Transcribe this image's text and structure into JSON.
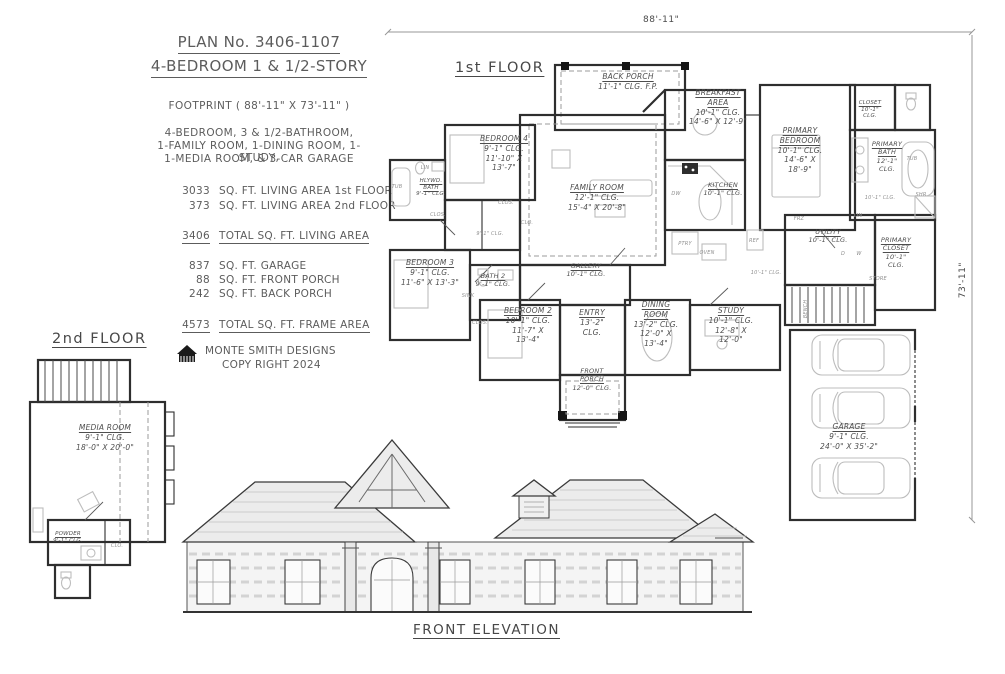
{
  "title_block": {
    "plan_no": "PLAN No. 3406-1107",
    "plan_type": "4-BEDROOM  1 & 1/2-STORY",
    "footprint": "FOOTPRINT ( 88'-11\" X 73'-11\" )",
    "description_lines": [
      "4-BEDROOM, 3 & 1/2-BATHROOM,",
      "1-FAMILY ROOM, 1-DINING ROOM, 1-STUDY,",
      "1-MEDIA ROOM, & 3-CAR GARAGE"
    ],
    "living_areas": [
      {
        "value": "3033",
        "label": "SQ. FT. LIVING AREA 1st FLOOR"
      },
      {
        "value": "373",
        "label": "SQ. FT. LIVING AREA 2nd FLOOR"
      }
    ],
    "total_living": {
      "value": "3406",
      "label": "TOTAL SQ. FT. LIVING AREA"
    },
    "misc_areas": [
      {
        "value": "837",
        "label": "SQ. FT. GARAGE"
      },
      {
        "value": "88",
        "label": "SQ. FT. FRONT PORCH"
      },
      {
        "value": "242",
        "label": "SQ. FT. BACK PORCH"
      }
    ],
    "total_frame": {
      "value": "4573",
      "label": "TOTAL SQ. FT. FRAME AREA"
    },
    "designer": "MONTE SMITH DESIGNS",
    "copyright": "COPY RIGHT 2024"
  },
  "first_floor": {
    "label": "1st FLOOR",
    "width_dim": "88'-11\"",
    "height_dim": "73'-11\"",
    "rooms": {
      "back_porch": {
        "name": "BACK PORCH",
        "details": "11'-1\" CLG. F.P."
      },
      "breakfast": {
        "name": "BREAKFAST\nAREA",
        "details": "10'-1\" CLG.\n14'-6\" X 12'-9\""
      },
      "primary_bedroom": {
        "name": "PRIMARY\nBEDROOM",
        "details": "10'-1\" CLG.\n14'-6\" X\n18'-9\""
      },
      "closet_upper": {
        "name": "CLOSET",
        "details": "10'-1\"\nCLG."
      },
      "primary_bath": {
        "name": "PRIMARY\nBATH",
        "details": "12'-1\"\nCLG."
      },
      "bedroom4": {
        "name": "BEDROOM 4",
        "details": "9'-1\" CLG.\n11'-10\" X\n13'-7\""
      },
      "hlywd_bath": {
        "name": "HLYWD.\nBATH",
        "details": "9'-1\" CLG."
      },
      "family_room": {
        "name": "FAMILY ROOM",
        "details": "12'-1\" CLG.\n15'-4\" X 20'-8\""
      },
      "kitchen": {
        "name": "KITCHEN",
        "details": "10'-1\" CLG."
      },
      "bedroom3": {
        "name": "BEDROOM 3",
        "details": "9'-1\" CLG.\n11'-6\" X 13'-3\""
      },
      "bath2": {
        "name": "BATH 2",
        "details": "9'-1\" CLG."
      },
      "gallery": {
        "name": "GALLERY",
        "details": "10'-1\" CLG."
      },
      "bedroom2": {
        "name": "BEDROOM 2",
        "details": "10'-1\" CLG.\n11'-7\" X\n13'-4\""
      },
      "entry": {
        "name": "ENTRY",
        "details": "13'-2\"\nCLG."
      },
      "dining_room": {
        "name": "DINING\nROOM",
        "details": "13'-2\" CLG.\n12'-0\" X\n13'-4\""
      },
      "study": {
        "name": "STUDY",
        "details": "10'-1\" CLG.\n12'-8\" X\n12'-0\""
      },
      "front_porch": {
        "name": "FRONT\nPORCH",
        "details": "12'-0\" CLG."
      },
      "utility": {
        "name": "UTILITY",
        "details": "10'-1\" CLG."
      },
      "primary_closet": {
        "name": "PRIMARY\nCLOSET",
        "details": "10'-1\"\nCLG."
      },
      "garage": {
        "name": "GARAGE",
        "details": "9'-1\" CLG.\n24'-0\" X 35'-2\""
      }
    },
    "fixtures": {
      "tub": "TUB",
      "shr": "SHR",
      "lin": "LIN",
      "dw": "DW",
      "ptry": "PTRY",
      "oven": "OVEN",
      "ref": "REF",
      "frz": "FRZ",
      "d": "D",
      "w": "W",
      "store": "STORE",
      "clos": "CLOS.",
      "clo": "CLO.",
      "sink": "SINK",
      "bench": "BENCH",
      "clg_91": "9'-1\" CLG.",
      "clg_101": "10'-1\" CLG."
    }
  },
  "second_floor": {
    "label": "2nd FLOOR",
    "rooms": {
      "media_room": {
        "name": "MEDIA ROOM",
        "details": "9'-1\" CLG.\n18'-0\" X 20'-0\""
      },
      "powder": {
        "name": "POWDER",
        "details": "9'-1\" CLG."
      }
    }
  },
  "elevation": {
    "label": "FRONT ELEVATION"
  }
}
